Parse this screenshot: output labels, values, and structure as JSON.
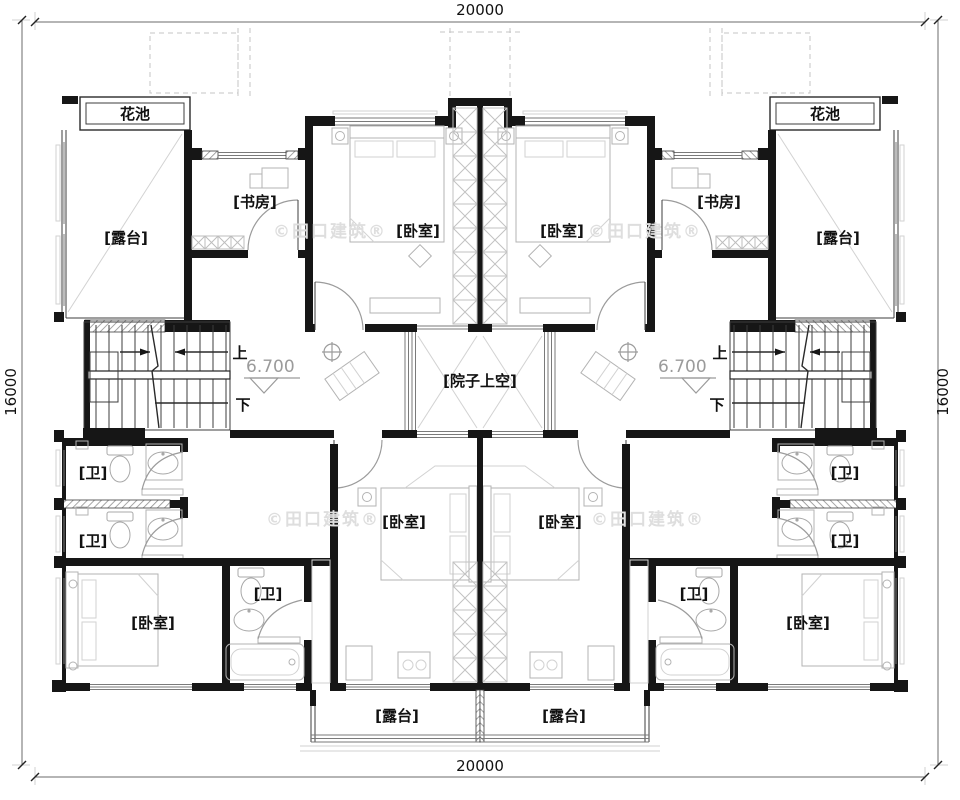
{
  "plan": {
    "type": "residential floor plan (symmetric duplex, upper storey)",
    "dimensions": {
      "width_mm": "20000",
      "height_mm": "16000"
    },
    "rooms": {
      "flower_bed": "花池",
      "terrace": "[露台]",
      "study": "[书房]",
      "bedroom": "[卧室]",
      "bath": "[卫]",
      "courtyard_void": "[院子上空]"
    },
    "stairs": {
      "up": "上",
      "down": "下",
      "elevation": "6.700"
    },
    "watermark": "©田口建筑®",
    "colors": {
      "wall": "#161616",
      "fixture": "#b3b3b3",
      "annotation_gray": "#9b9b9b",
      "background": "#ffffff"
    }
  }
}
